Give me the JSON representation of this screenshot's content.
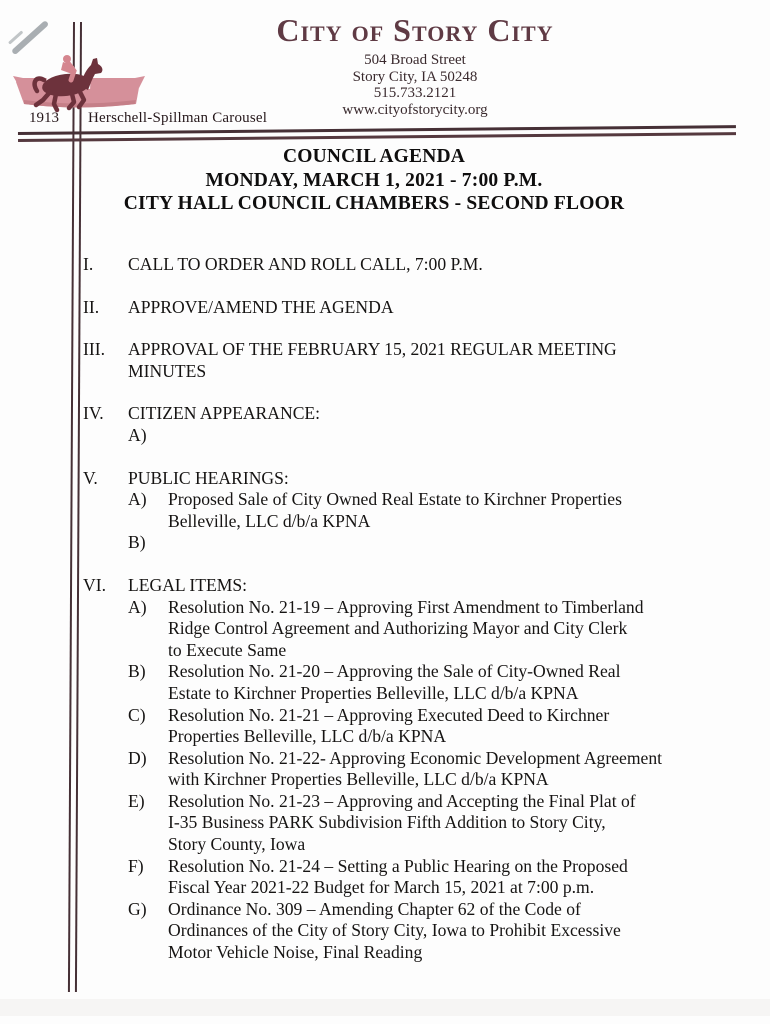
{
  "document": {
    "header": {
      "org_name": "City of Story City",
      "address_line1": "504 Broad Street",
      "address_line2": "Story City, IA 50248",
      "phone": "515.733.2121",
      "website": "www.cityofstorycity.org"
    },
    "logo": {
      "icon": "carousel-horse-icon",
      "year": "1913",
      "caption": "Herschell-Spillman Carousel"
    },
    "title_block": {
      "line1": "COUNCIL AGENDA",
      "line2": "MONDAY, MARCH 1, 2021 - 7:00 P.M.",
      "line3": "CITY HALL COUNCIL CHAMBERS - SECOND FLOOR"
    },
    "agenda": [
      {
        "numeral": "I.",
        "title": "CALL TO ORDER AND ROLL CALL, 7:00 P.M.",
        "items": []
      },
      {
        "numeral": "II.",
        "title": "APPROVE/AMEND THE AGENDA",
        "items": []
      },
      {
        "numeral": "III.",
        "title": "APPROVAL OF THE FEBRUARY 15, 2021 REGULAR MEETING\nMINUTES",
        "items": []
      },
      {
        "numeral": "IV.",
        "title": "CITIZEN APPEARANCE:",
        "items": [
          {
            "letter": "A)",
            "text": ""
          }
        ]
      },
      {
        "numeral": "V.",
        "title": "PUBLIC HEARINGS:",
        "items": [
          {
            "letter": "A)",
            "text": "Proposed Sale of City Owned Real Estate to Kirchner Properties\nBelleville, LLC d/b/a KPNA"
          },
          {
            "letter": "B)",
            "text": ""
          }
        ]
      },
      {
        "numeral": "VI.",
        "title": "LEGAL ITEMS:",
        "items": [
          {
            "letter": "A)",
            "text": "Resolution No. 21-19 – Approving First Amendment to Timberland\nRidge Control Agreement and Authorizing Mayor and City Clerk\nto Execute Same"
          },
          {
            "letter": "B)",
            "text": "Resolution No. 21-20 – Approving the Sale of City-Owned Real\nEstate to Kirchner Properties Belleville, LLC d/b/a KPNA"
          },
          {
            "letter": "C)",
            "text": "Resolution No. 21-21 – Approving Executed Deed to Kirchner\nProperties Belleville, LLC d/b/a KPNA"
          },
          {
            "letter": "D)",
            "text": "Resolution No. 21-22- Approving Economic Development Agreement\nwith Kirchner Properties Belleville, LLC d/b/a KPNA"
          },
          {
            "letter": "E)",
            "text": "Resolution No. 21-23 – Approving and Accepting the Final Plat of\nI-35 Business PARK Subdivision Fifth Addition to Story City,\nStory County, Iowa"
          },
          {
            "letter": "F)",
            "text": "Resolution No. 21-24 – Setting a Public Hearing on the Proposed\nFiscal Year 2021-22 Budget for March 15, 2021 at 7:00 p.m."
          },
          {
            "letter": "G)",
            "text": "Ordinance No. 309 – Amending Chapter 62 of the Code of\nOrdinances of the City of Story City, Iowa to Prohibit Excessive\nMotor Vehicle Noise, Final Reading"
          }
        ]
      }
    ],
    "colors": {
      "header_maroon": "#5f3a44",
      "canopy_pink": "#d5909a",
      "horse_maroon": "#6d323c",
      "rule_dark": "#463036",
      "body_ink": "#161413"
    }
  }
}
